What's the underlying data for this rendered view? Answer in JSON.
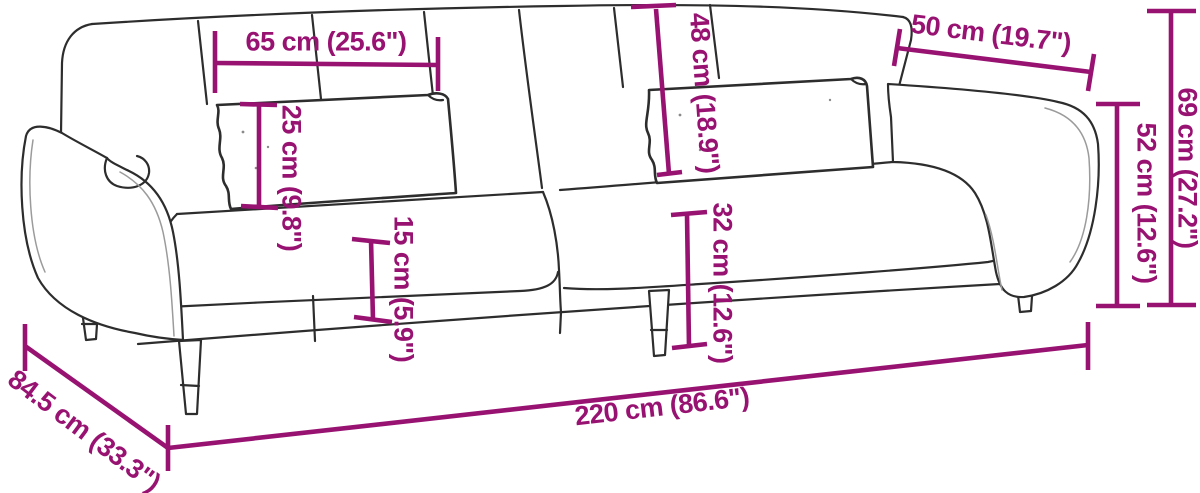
{
  "diagram": {
    "colors": {
      "accent": "#981272",
      "line": "#2d2d2d",
      "background": "#ffffff"
    },
    "dimensions": [
      {
        "id": "dim-65",
        "cm": "65",
        "inches": "25.6",
        "label": "65 cm (25.6\")"
      },
      {
        "id": "dim-48",
        "cm": "48",
        "inches": "18.9",
        "label": "48 cm (18.9\")"
      },
      {
        "id": "dim-50",
        "cm": "50",
        "inches": "19.7",
        "label": "50 cm (19.7\")"
      },
      {
        "id": "dim-69",
        "cm": "69",
        "inches": "27.2",
        "label": "69 cm (27.2\")"
      },
      {
        "id": "dim-52",
        "cm": "52",
        "inches": "12.6",
        "label": "52 cm (12.6\")"
      },
      {
        "id": "dim-25",
        "cm": "25",
        "inches": "9.8",
        "label": "25 cm (9.8\")"
      },
      {
        "id": "dim-15",
        "cm": "15",
        "inches": "5.9",
        "label": "15 cm (5.9\")"
      },
      {
        "id": "dim-32",
        "cm": "32",
        "inches": "12.6",
        "label": "32 cm (12.6\")"
      },
      {
        "id": "dim-220",
        "cm": "220",
        "inches": "86.6",
        "label": "220 cm (86.6\")"
      },
      {
        "id": "dim-84",
        "cm": "84.5",
        "inches": "33.3",
        "label": "84.5 cm (33.3\")"
      }
    ]
  }
}
